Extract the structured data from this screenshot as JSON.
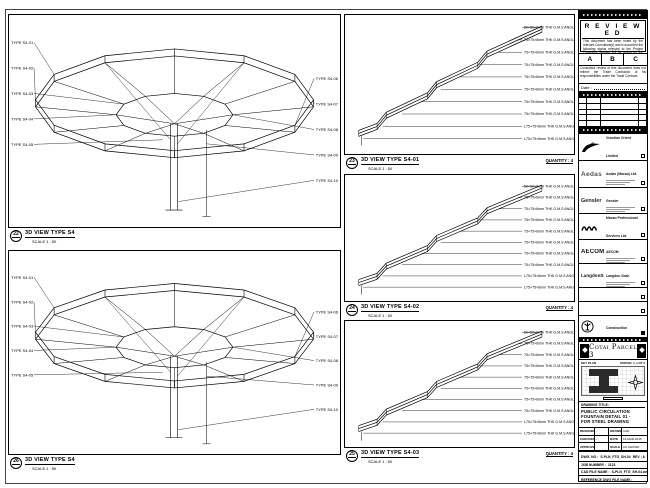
{
  "colors": {
    "line": "#000000",
    "paper": "#ffffff"
  },
  "viewports": {
    "left_top": {
      "bubble": "22",
      "title": "3D VIEW TYPE S4",
      "scale": "SCALE 1 : 50",
      "labels": [
        "TYPE S4-01",
        "TYPE S4-02",
        "TYPE S4-03",
        "TYPE S4-04",
        "TYPE S4-05",
        "TYPE S4-06",
        "TYPE S4-07",
        "TYPE S4-08",
        "TYPE S4-09",
        "TYPE S4-10"
      ]
    },
    "left_bottom": {
      "bubble": "26",
      "title": "3D VIEW TYPE S4",
      "scale": "SCALE 1 : 50",
      "labels": [
        "TYPE S4-01",
        "TYPE S4-02",
        "TYPE S4-03",
        "TYPE S4-04",
        "TYPE S4-05",
        "TYPE S4-06",
        "TYPE S4-07",
        "TYPE S4-08",
        "TYPE S4-09",
        "TYPE S4-10"
      ]
    },
    "right_top": {
      "bubble": "23",
      "title": "3D VIEW TYPE S4-01",
      "scale": "SCALE 1 : 50",
      "quantity": "QUANTITY : 4",
      "annotations": [
        "50×50×6mm THK G.M.S ANGLE",
        "75×75×6mm THK G.M.S ANGLE",
        "75×75×6mm THK G.M.S ANGLE",
        "75×75×6mm THK G.M.S ANGLE",
        "75×75×6mm THK G.M.S ANGLE",
        "75×75×6mm THK G.M.S ANGLE",
        "75×75×6mm THK G.M.S ANGLE",
        "75×75×6mm THK G.M.S ANGLE",
        "L75×75×6mm THK G.M.S ANGLE",
        "L75×75×6mm THK G.M.S ANGLE"
      ]
    },
    "right_mid": {
      "bubble": "24",
      "title": "3D VIEW TYPE S4-02",
      "scale": "SCALE 1 : 50",
      "quantity": "QUANTITY : 4",
      "annotations": [
        "50×50×6mm THK G.M.S ANGLE",
        "75×75×6mm THK G.M.S ANGLE",
        "75×75×6mm THK G.M.S ANGLE",
        "75×75×6mm THK G.M.S ANGLE",
        "75×75×6mm THK G.M.S ANGLE",
        "75×75×6mm THK G.M.S ANGLE",
        "75×75×6mm THK G.M.S ANGLE",
        "75×75×6mm THK G.M.S ANGLE",
        "L75×75×6mm THK G.M.S ANGLE",
        "L75×75×6mm THK G.M.S ANGLE"
      ]
    },
    "right_bottom": {
      "bubble": "25",
      "title": "3D VIEW TYPE S4-03",
      "scale": "SCALE 1 : 50",
      "quantity": "QUANTITY : 4",
      "annotations": [
        "50×50×6mm THK G.M.S ANGLE",
        "75×75×6mm THK G.M.S ANGLE",
        "75×75×6mm THK G.M.S ANGLE",
        "75×75×6mm THK G.M.S ANGLE",
        "75×75×6mm THK G.M.S ANGLE",
        "75×75×6mm THK G.M.S ANGLE",
        "75×75×6mm THK G.M.S ANGLE",
        "75×75×6mm THK G.M.S ANGLE",
        "L75×75×6mm THK G.M.S ANGLE",
        "L75×75×6mm THK G.M.S ANGLE"
      ]
    }
  },
  "title_block": {
    "review": {
      "title": "R E V I E W E D",
      "body": "This document has been noted by the relevant Consultant(s) and is accorded the following status relevant to the Project Procedure Section 5.4 for action by the Trade Contractor.",
      "grades": [
        "A",
        "B",
        "C"
      ],
      "note": "Consultant review of this document does not relieve the Trade Contractor of his responsibilities under the Trade Contract.",
      "date_label": "Date :"
    },
    "companies": [
      {
        "name": "Venetian Orient Limited"
      },
      {
        "name": "Aedas (Macau) Ltd.",
        "logo_text": "Aedas"
      },
      {
        "name": "Gensler",
        "logo_text": "Gensler"
      },
      {
        "name": "Macau Professional Services Ltd."
      },
      {
        "name": "AECOM",
        "logo_text": "AECOM"
      },
      {
        "name": "Langdon Seah",
        "logo_text": "LangdonSeah"
      },
      {
        "name": ""
      },
      {
        "name": ""
      },
      {
        "name": "Hsin Chong Construction (Macau) Co., Ltd."
      }
    ],
    "banner": "Cotai Parcel 3",
    "key_plan": {
      "label": "KEY PLAN",
      "parcel": "PARCEL 1, LOT 2"
    },
    "drawing_title": {
      "label": "DRAWING TITLE:",
      "line1": "PUBLIC CIRCULATION",
      "line2": "FOUNTAIN DETAIL 01 -",
      "line3": "FOR STEEL DRAWING"
    },
    "fields": {
      "designed_label": "DESIGNED",
      "designed": "-",
      "drawn_label": "DRAWN",
      "drawn": "CAD",
      "checked_label": "CHECKED",
      "checked": "-",
      "date_label": "DATE",
      "date": "14-MAR-2016",
      "approved_label": "APPROVED",
      "approved": "-",
      "scale_label": "SCALE",
      "scale": "AS SHOWN"
    },
    "dwg_label": "DWG. NO :",
    "dwg_no": "S-PLN_FTG_SH-04",
    "rev": "REV : A",
    "job_label": "JOB NUMBER :",
    "job": "2123",
    "cad_label": "CAD FILE NAME :",
    "cad": "S-PLN_FTG_SH-04.dwg",
    "ref_label": "REFERENCE DWG FILE NAME :"
  }
}
